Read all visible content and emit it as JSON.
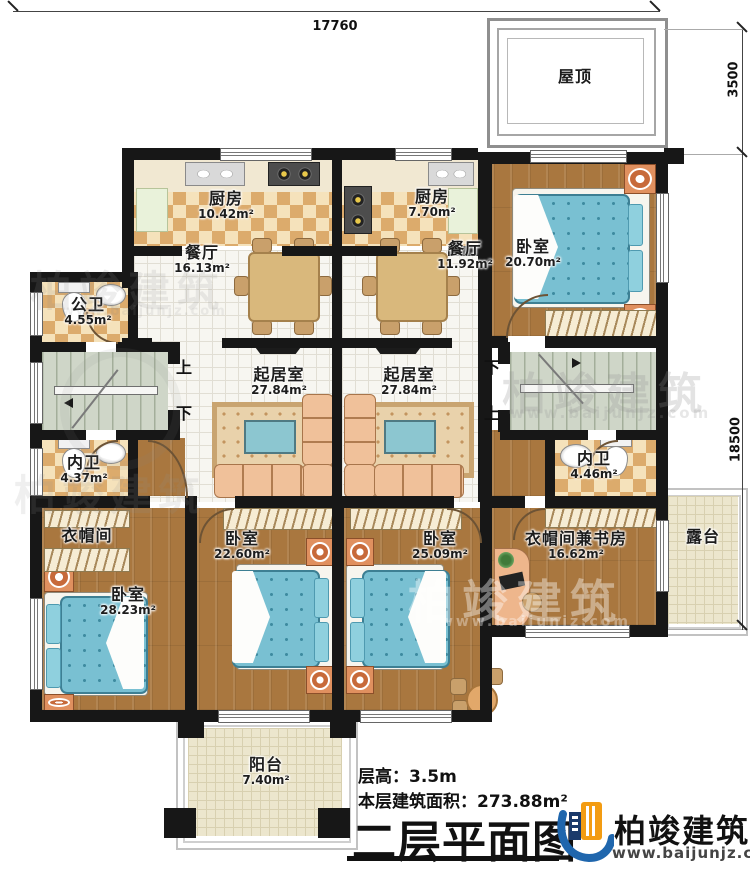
{
  "dims": {
    "width": "17760",
    "roof_height": "3500",
    "depth": "18500"
  },
  "rooms": {
    "roof": {
      "label": "屋顶"
    },
    "kitchen1": {
      "label": "厨房",
      "area": "10.42m²"
    },
    "kitchen2": {
      "label": "厨房",
      "area": "7.70m²"
    },
    "dining1": {
      "label": "餐厅",
      "area": "16.13m²"
    },
    "dining2": {
      "label": "餐厅",
      "area": "11.92m²"
    },
    "bedroom_tr": {
      "label": "卧室",
      "area": "20.70m²"
    },
    "public_bath": {
      "label": "公卫",
      "area": "4.55m²"
    },
    "bath_left": {
      "label": "内卫",
      "area": "4.37m²"
    },
    "bath_right": {
      "label": "内卫",
      "area": "4.46m²"
    },
    "living1": {
      "label": "起居室",
      "area": "27.84m²"
    },
    "living2": {
      "label": "起居室",
      "area": "27.84m²"
    },
    "cloak": {
      "label": "衣帽间"
    },
    "bedroom_bl": {
      "label": "卧室",
      "area": "28.23m²"
    },
    "bedroom_bc1": {
      "label": "卧室",
      "area": "22.60m²"
    },
    "bedroom_bc2": {
      "label": "卧室",
      "area": "25.09m²"
    },
    "cloak_study": {
      "label": "衣帽间兼书房",
      "area": "16.62m²"
    },
    "terrace": {
      "label": "露台"
    },
    "balcony": {
      "label": "阳台",
      "area": "7.40m²"
    }
  },
  "stairs": {
    "left": {
      "up": "上",
      "down": "下"
    },
    "right": {
      "up": "上",
      "down": "下"
    }
  },
  "footer": {
    "floor_height": "层高：3.5m",
    "floor_area": "本层建筑面积：273.88m²",
    "title": "二层平面图",
    "brand": "柏竣建筑",
    "site": "www.baijunjz.com"
  },
  "watermark": {
    "brand": "柏竣建筑",
    "site": "www.baijunjz.com"
  },
  "colors": {
    "wall": "#171717",
    "bed": "#79c0d2",
    "wood": "#a9773f",
    "brand_blue": "#1f66ad",
    "brand_orange": "#f39c12"
  }
}
